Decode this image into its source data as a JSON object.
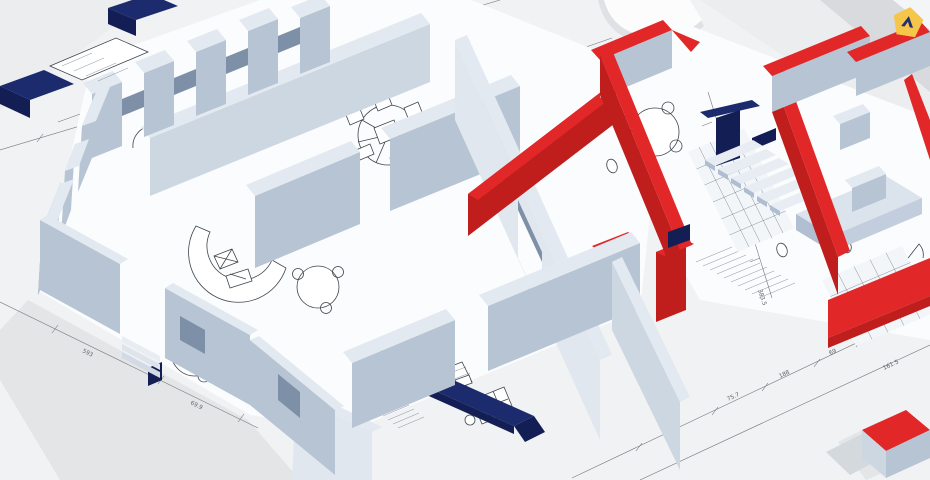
{
  "scene": {
    "description": "3D axonometric floor plan of a building, cut-away walls with renovation highlights",
    "highlight_red_walls": "red-highlighted walls",
    "highlight_navy_walls": "navy-highlighted walls"
  },
  "badge": {
    "icon": "location-marker"
  },
  "dims": [
    "979",
    "598.50",
    "30",
    "15",
    "593",
    "69.9",
    "151.3",
    "75.7",
    "188",
    "69",
    "60",
    "140.5",
    "143.3",
    "103",
    "383.5",
    "161.5",
    "90.5",
    "210"
  ],
  "colors": {
    "bg": "#ebedee",
    "bg_light": "#f4f5f6",
    "band": "#d8dadd",
    "floor": "#fbfcfd",
    "wall_top": "#e3e9f0",
    "wall_front": "#b7c4d4",
    "wall_side": "#cdd7e2",
    "wall_lit": "#e0e7ef",
    "wall_dark": "#7d90a7",
    "red": "#e12727",
    "red_dark": "#c01d1d",
    "navy": "#1c2a6e",
    "navy_dark": "#131f54",
    "dim": "#5c6066",
    "glyph": "#3f454c",
    "shadow": "#9aa1a9",
    "badge": "#f6c64a",
    "badge_icon": "#22306f",
    "white": "#fdfdfd"
  }
}
